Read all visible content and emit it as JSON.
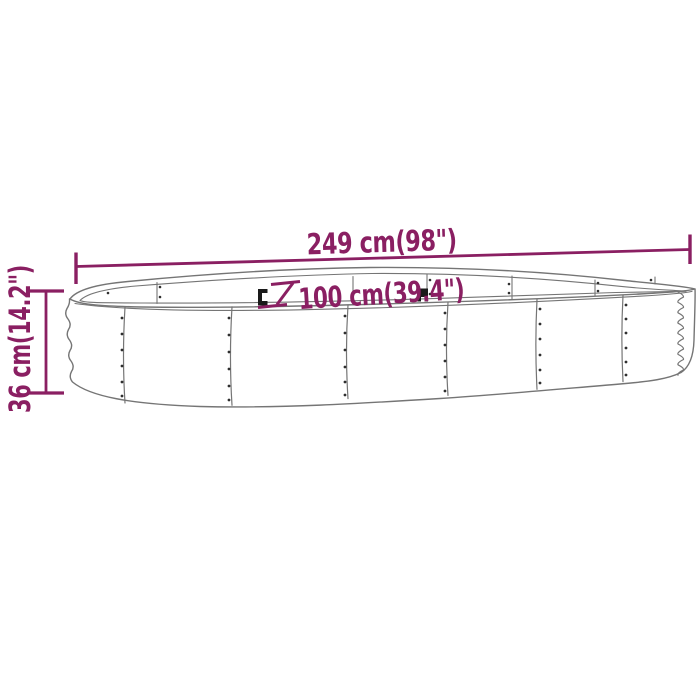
{
  "diagram": {
    "labels": {
      "length": "249 cm(98\")",
      "width": "100 cm(39.4\")",
      "height": "36 cm(14.2\")"
    },
    "colors": {
      "dimension_accent": "#8a1f62",
      "outline_gray": "#757575",
      "rivet_dark": "#2f2f2f",
      "background": "#ffffff"
    }
  }
}
